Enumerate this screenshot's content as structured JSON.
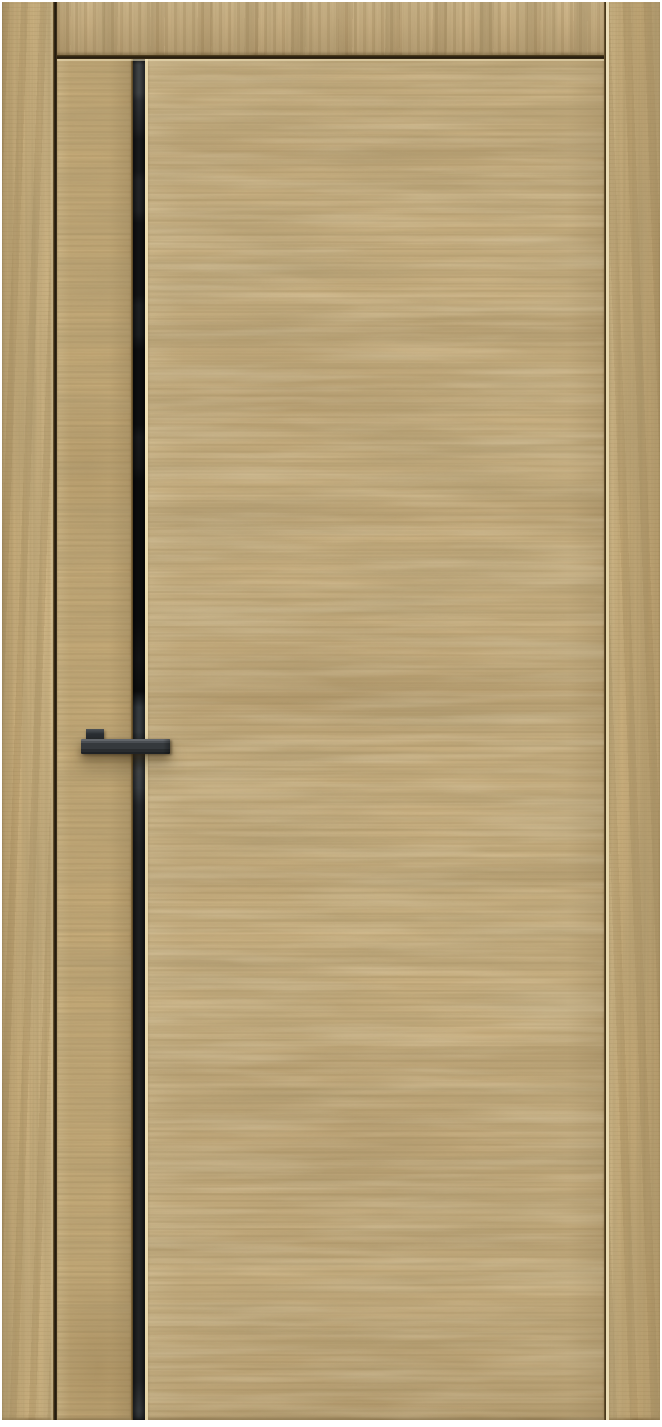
{
  "scene": {
    "title": "Interior door with natural oak finish, black vertical glass insert and black rectangular handle, shown in matching oak frame on white background",
    "background_color": "#ffffff"
  },
  "door": {
    "finish": "light natural oak woodgrain, horizontal cathedral figure",
    "insert_strip": "black tinted glass vertical insert with grey reflections",
    "handle": "black rectangular lever handle crossing the insert strip",
    "frame": "matching oak jambs and header with shadow gaps around the leaf"
  },
  "colors": {
    "wood_base": "#c9b082",
    "wood_grain_dark": "#a0834f",
    "wood_highlight_line": "#ecdcb2",
    "gap_shadow": "#241b0e",
    "insert_black": "#121315",
    "insert_reflection_gray": "#45494c",
    "handle_black": "#33373b",
    "handle_top_sheen": "#62666b",
    "background": "#ffffff"
  }
}
